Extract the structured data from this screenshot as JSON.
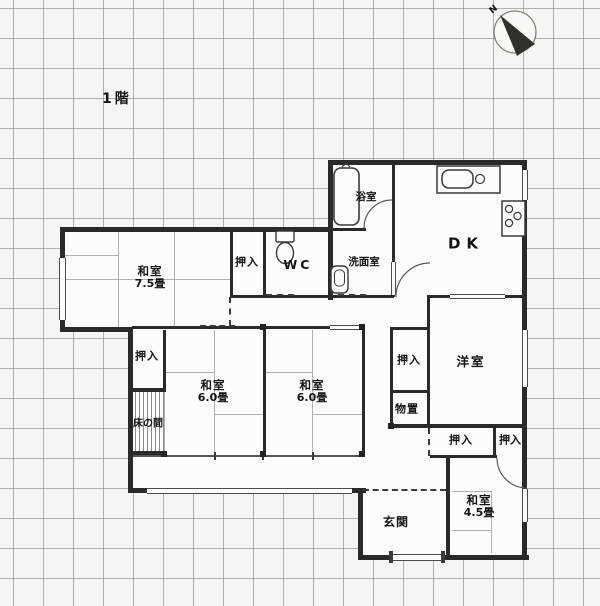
{
  "floor_label": "1階",
  "compass": {
    "north_label": "N"
  },
  "rooms": {
    "washitsu75": {
      "name": "和室",
      "size": "7.5畳"
    },
    "oshiire_wc": {
      "name": "押入"
    },
    "wc": {
      "name": "WC"
    },
    "senmenshitsu": {
      "name": "洗面室"
    },
    "yokushitsu": {
      "name": "浴室"
    },
    "dk": {
      "name": "DK"
    },
    "oshiire_mid": {
      "name": "押入"
    },
    "tokonoma": {
      "name": "床の間"
    },
    "washitsu60_left": {
      "name": "和室",
      "size": "6.0畳"
    },
    "washitsu60_right": {
      "name": "和室",
      "size": "6.0畳"
    },
    "oshiire_yoshitsu": {
      "name": "押入"
    },
    "yoshitsu": {
      "name": "洋室"
    },
    "monooki": {
      "name": "物置"
    },
    "oshiire_south1": {
      "name": "押入"
    },
    "oshiire_south2": {
      "name": "押入"
    },
    "washitsu45": {
      "name": "和室",
      "size": "4.5畳"
    },
    "genkan": {
      "name": "玄関"
    }
  },
  "fixtures": {
    "bathtub": "bathtub",
    "toilet": "toilet",
    "washbasin": "washbasin",
    "kitchen_sink": "kitchen-sink",
    "stove": "stove"
  },
  "colors": {
    "wall": "#2b2a27",
    "paper": "#f7f5f1",
    "grid_line": "#a8a8a8",
    "fixture_line": "#3a3a38"
  }
}
